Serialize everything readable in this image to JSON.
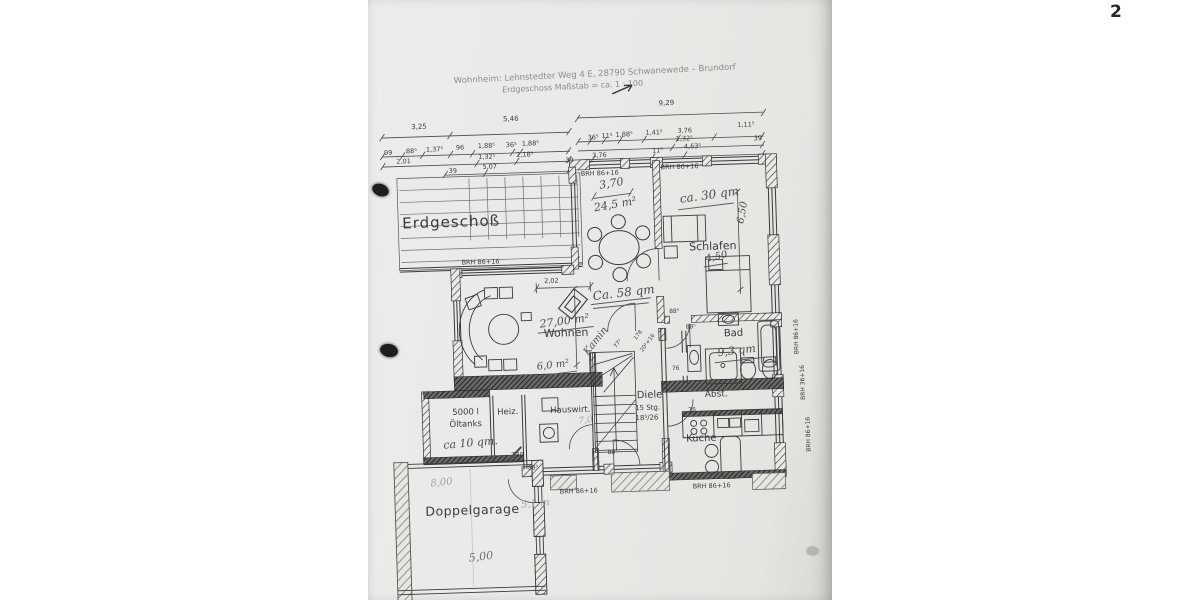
{
  "page": {
    "number": "2"
  },
  "header": {
    "line1": "Wohnheim: Lehnstedter Weg 4 E, 28790 Schwanewede – Brundorf",
    "line2": "Erdgeschoss   Maßstab = ca. 1 : 100"
  },
  "plan_title": "Erdgeschoß",
  "dims": {
    "row1": [
      "3,25",
      "5,46",
      "9,29"
    ],
    "row2": [
      "99",
      "88⁵",
      "1,37⁵",
      "96",
      "1,88⁵",
      "36⁵",
      "1,88⁵",
      "36⁵",
      "11⁵",
      "1,88⁵",
      "1,41⁵",
      "3,76",
      "1,11⁵"
    ],
    "row3": [
      "2,01",
      "1,32⁵",
      "2,18⁵",
      "1,32⁵"
    ],
    "row4": [
      "39",
      "5,07",
      "39",
      "3,76",
      "11⁵",
      "4,63⁵",
      "39"
    ],
    "d202": "2,02",
    "d885": "88⁵",
    "d76": "76",
    "d775": "77⁵",
    "d178": "178",
    "d201": "20¹+16"
  },
  "sill": {
    "brh": "BRH 86+16",
    "brh36": "BRH 36+16"
  },
  "rooms": {
    "wohnen": "Wohnen",
    "schlafen": "Schlafen",
    "bad": "Bad",
    "kueche": "Küche",
    "diele": "Diele",
    "stairs1": "15 Stg.",
    "stairs2": "18⁵/26",
    "hauswirt": "Hauswirt.",
    "heiz": "Heiz.",
    "oeltank1": "5000 l",
    "oeltank2": "Öltanks",
    "abst": "Abst.",
    "garage": "Doppelgarage",
    "t30": "T30"
  },
  "handwritten": {
    "dining_width": "3,70",
    "dining_area": "24,5 m²",
    "schlafen_area": "ca. 30 qm",
    "schlafen_len": "6,50",
    "schlafen_wid": "4,50",
    "living_total": "Ca. 58 qm",
    "wohnen_area": "27,00 m²",
    "kamin_area": "6,0 m²",
    "kamin": "Kamin",
    "bad_area": "9,3 qm",
    "tank_area": "ca 10 qm.",
    "hall_width": "7,0",
    "garage_len": "5,00",
    "garage_wid": "8,00",
    "garage_d": "5,1 m"
  }
}
